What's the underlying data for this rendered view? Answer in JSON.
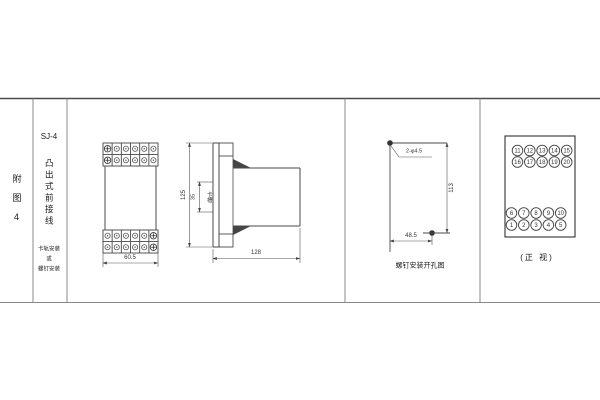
{
  "figure": {
    "row_label": "附图4",
    "model": "SJ-4",
    "type_label": "凸出式前接线",
    "mount_lines": [
      "卡轨安装",
      "或",
      "螺钉安装"
    ]
  },
  "front_view": {
    "width_dim": "60.5"
  },
  "side_view": {
    "height_dim": "125",
    "slot_dim": "35",
    "slot_label": "卡槽",
    "depth_dim": "128"
  },
  "drill_view": {
    "holes_label": "2-φ4.5",
    "height_dim": "113",
    "width_dim": "48.5",
    "caption": "螺钉安装开孔图"
  },
  "terminal_view": {
    "caption": "(正 视)",
    "top_rows": [
      [
        "11",
        "12",
        "13",
        "14",
        "15"
      ],
      [
        "16",
        "17",
        "18",
        "19",
        "20"
      ]
    ],
    "bottom_rows": [
      [
        "6",
        "7",
        "8",
        "9",
        "10"
      ],
      [
        "1",
        "2",
        "3",
        "4",
        "5"
      ]
    ]
  }
}
